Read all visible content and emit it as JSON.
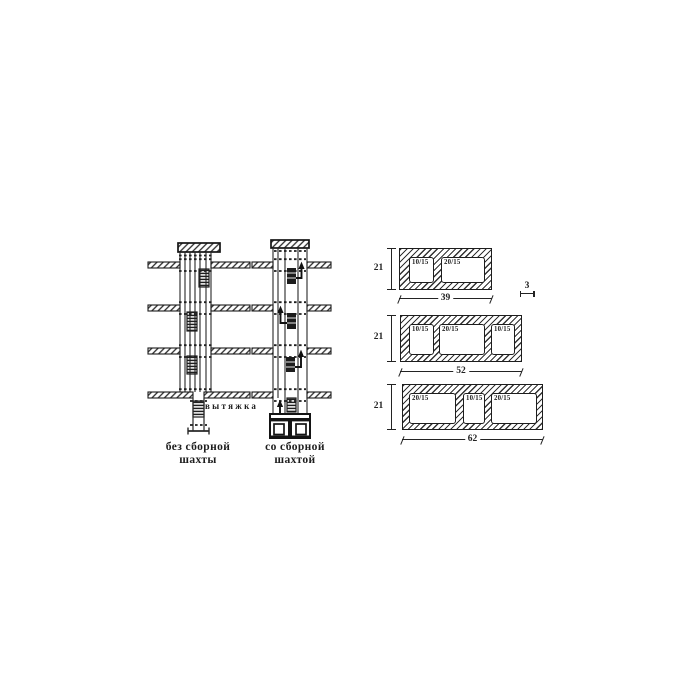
{
  "figure": {
    "background": "#ffffff",
    "ink": "#222222",
    "left_diagram": {
      "exhaust_label": "вытяжка",
      "caption": [
        "без сборной",
        "шахты"
      ]
    },
    "right_diagram": {
      "caption": [
        "со сборной",
        "шахтой"
      ]
    },
    "blocks": [
      {
        "name": "block-39",
        "height_dim": "21",
        "width_dim": "39",
        "wall_dim": "3",
        "openings": [
          "10/15",
          "20/15"
        ]
      },
      {
        "name": "block-52",
        "height_dim": "21",
        "width_dim": "52",
        "openings": [
          "10/15",
          "20/15",
          "10/15"
        ]
      },
      {
        "name": "block-62",
        "height_dim": "21",
        "width_dim": "62",
        "openings": [
          "20/15",
          "10/15",
          "20/15"
        ]
      }
    ]
  }
}
